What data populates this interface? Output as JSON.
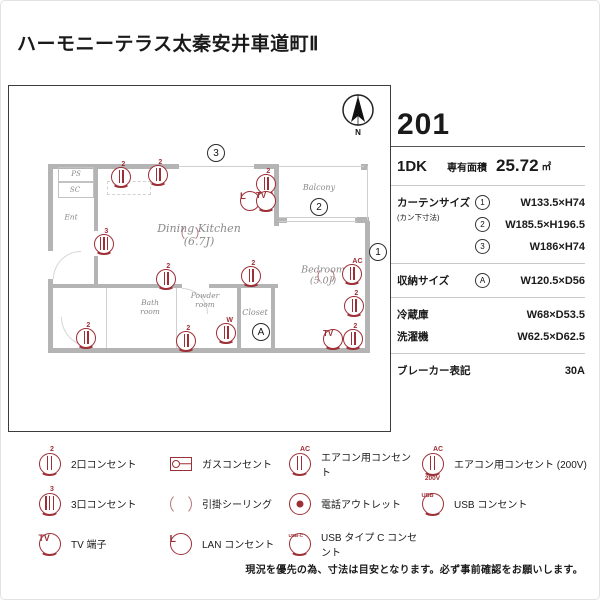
{
  "page": {
    "title": "ハーモニーテラス太秦安井車道町Ⅱ",
    "note": "現況を優先の為、寸法は目安となります。必ず事前確認をお願いします。"
  },
  "unit": {
    "number": "201",
    "layout": "1DK",
    "area_label": "専有面積",
    "area_value": "25.72",
    "area_unit": "㎡",
    "curtain": {
      "label": "カーテンサイズ",
      "sublabel": "(カン下寸法)",
      "rows": [
        {
          "marker": "1",
          "value": "W133.5×H74"
        },
        {
          "marker": "2",
          "value": "W185.5×H196.5"
        },
        {
          "marker": "3",
          "value": "W186×H74"
        }
      ]
    },
    "storage": {
      "label": "収納サイズ",
      "marker": "A",
      "value": "W120.5×D56"
    },
    "fridge": {
      "label": "冷蔵庫",
      "value": "W68×D53.5"
    },
    "washer": {
      "label": "洗濯機",
      "value": "W62.5×D62.5"
    },
    "breaker": {
      "label": "ブレーカー表記",
      "value": "30A"
    }
  },
  "floorplan": {
    "compass_label": "N",
    "walls": [
      [
        39,
        78,
        131,
        5
      ],
      [
        245,
        78,
        24,
        5
      ],
      [
        265,
        78,
        5,
        62
      ],
      [
        39,
        78,
        5,
        87
      ],
      [
        39,
        193,
        5,
        74
      ],
      [
        85,
        78,
        4,
        67
      ],
      [
        85,
        170,
        4,
        28
      ],
      [
        39,
        198,
        134,
        4
      ],
      [
        200,
        198,
        69,
        4
      ],
      [
        228,
        198,
        4,
        64
      ],
      [
        262,
        198,
        4,
        64
      ],
      [
        356,
        135,
        5,
        132
      ],
      [
        39,
        262,
        322,
        5
      ],
      [
        268,
        131,
        10,
        6
      ],
      [
        346,
        131,
        14,
        6
      ],
      [
        352,
        78,
        7,
        6
      ]
    ],
    "thin_lines": [
      [
        170,
        80,
        75,
        1
      ],
      [
        270,
        80,
        85,
        1
      ],
      [
        358,
        80,
        1,
        54
      ],
      [
        270,
        131,
        78,
        1
      ],
      [
        270,
        135,
        78,
        1
      ],
      [
        167,
        202,
        1,
        60
      ],
      [
        97,
        202,
        1,
        60
      ]
    ],
    "boxes": [
      [
        49,
        81,
        36,
        15
      ],
      [
        49,
        96,
        36,
        16
      ]
    ],
    "dash_rects": [
      [
        98,
        95,
        44,
        14
      ]
    ],
    "door_arcs": [
      {
        "x": 44,
        "y": 165,
        "s": 28,
        "c": "tl"
      },
      {
        "x": 173,
        "y": 202,
        "s": 26,
        "c": "tr"
      },
      {
        "x": 52,
        "y": 231,
        "s": 30,
        "c": "bl"
      }
    ],
    "rooms": [
      {
        "lines": [
          "PS"
        ],
        "x": 67,
        "y": 88,
        "fs": 7
      },
      {
        "lines": [
          "SC"
        ],
        "x": 66,
        "y": 104,
        "fs": 7
      },
      {
        "lines": [
          "Ent"
        ],
        "x": 62,
        "y": 131,
        "fs": 7.5
      },
      {
        "lines": [
          "Dining Kitchen",
          "(6.7J)"
        ],
        "x": 190,
        "y": 149,
        "fs": 11
      },
      {
        "lines": [
          "Balcony"
        ],
        "x": 310,
        "y": 102,
        "fs": 8
      },
      {
        "lines": [
          "Bedroom",
          "(5.0J)"
        ],
        "x": 314,
        "y": 190,
        "fs": 9.5
      },
      {
        "lines": [
          "Bath",
          "room"
        ],
        "x": 141,
        "y": 221,
        "fs": 7.5
      },
      {
        "lines": [
          "Powder",
          "room"
        ],
        "x": 196,
        "y": 214,
        "fs": 7.5
      },
      {
        "lines": [
          "Closet"
        ],
        "x": 246,
        "y": 227,
        "fs": 8
      }
    ],
    "markers": [
      {
        "t": "3",
        "x": 207,
        "y": 67
      },
      {
        "t": "2",
        "x": 310,
        "y": 121
      },
      {
        "t": "1",
        "x": 369,
        "y": 166
      },
      {
        "t": "A",
        "x": 252,
        "y": 246
      }
    ],
    "icons": [
      {
        "type": "outlet",
        "bars": 2,
        "top": "2",
        "x": 112,
        "y": 91
      },
      {
        "type": "outlet",
        "bars": 2,
        "top": "2",
        "x": 149,
        "y": 89
      },
      {
        "type": "outlet",
        "bars": 3,
        "top": "3",
        "x": 95,
        "y": 158
      },
      {
        "type": "outlet",
        "bars": 2,
        "top": "2",
        "x": 257,
        "y": 98
      },
      {
        "type": "lan",
        "glyph": "L",
        "x": 241,
        "y": 115
      },
      {
        "type": "tv",
        "glyph": "TV",
        "x": 257,
        "y": 115
      },
      {
        "type": "ceiling",
        "x": 181,
        "y": 147,
        "size": 17
      },
      {
        "type": "ceiling",
        "x": 317,
        "y": 190,
        "size": 17
      },
      {
        "type": "ac",
        "bars": 2,
        "top": "AC",
        "x": 343,
        "y": 188
      },
      {
        "type": "outlet",
        "bars": 2,
        "top": "2",
        "x": 345,
        "y": 220
      },
      {
        "type": "tv",
        "glyph": "TV",
        "x": 324,
        "y": 253
      },
      {
        "type": "outlet",
        "bars": 2,
        "top": "2",
        "x": 344,
        "y": 253
      },
      {
        "type": "outlet",
        "bars": 2,
        "top": "2",
        "x": 242,
        "y": 190
      },
      {
        "type": "outlet",
        "bars": 2,
        "top": "2",
        "x": 157,
        "y": 193
      },
      {
        "type": "outlet",
        "bars": 2,
        "top": "2",
        "x": 77,
        "y": 252
      },
      {
        "type": "outlet",
        "bars": 2,
        "top": "2",
        "x": 177,
        "y": 255
      },
      {
        "type": "outlet",
        "bars": 2,
        "top": "W",
        "x": 217,
        "y": 247
      }
    ]
  },
  "legend": {
    "items": [
      {
        "type": "outlet",
        "bars": 2,
        "top": "2",
        "text": "2口コンセント"
      },
      {
        "type": "gas",
        "text": "ガスコンセント"
      },
      {
        "type": "ac",
        "bars": 2,
        "top": "AC",
        "text": "エアコン用コンセント"
      },
      {
        "type": "ac",
        "bars": 2,
        "top": "AC",
        "bottom": "200V",
        "text": "エアコン用コンセント (200V)"
      },
      {
        "type": "outlet",
        "bars": 3,
        "top": "3",
        "text": "3口コンセント"
      },
      {
        "type": "ceiling",
        "text": "引掛シーリング"
      },
      {
        "type": "phone",
        "text": "電話アウトレット"
      },
      {
        "type": "usb",
        "glyph": "USB",
        "text": "USB コンセント"
      },
      {
        "type": "tv",
        "glyph": "TV",
        "text": "TV 端子"
      },
      {
        "type": "lan",
        "glyph": "L",
        "text": "LAN コンセント"
      },
      {
        "type": "usbc",
        "glyph": "USB-C",
        "text": "USB タイプ C コンセント"
      }
    ]
  }
}
